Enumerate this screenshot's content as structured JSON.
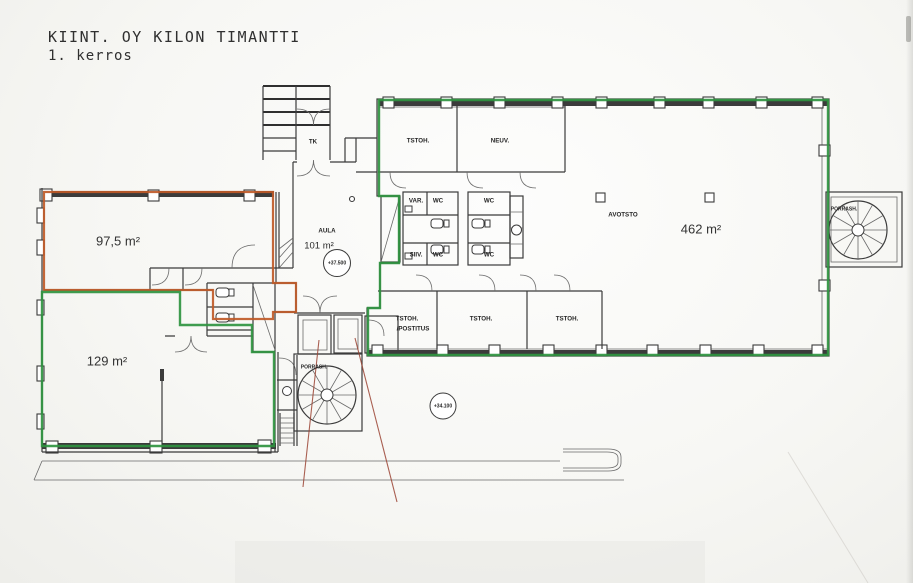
{
  "document": {
    "title": "KIINT. OY KILON TIMANTTI",
    "subtitle": "1. kerros"
  },
  "colors": {
    "unit_a_outline": "#bf5a28",
    "unit_b_outline": "#2f9440",
    "walls": "#3b3b3b",
    "leader_lines": "#9b4434"
  },
  "units": {
    "unit_a": {
      "area": "97,5 m²"
    },
    "unit_b": {
      "area": "129 m²"
    },
    "open_office_unit": {
      "area": "462 m²"
    }
  },
  "rooms": {
    "aula": {
      "name": "AULA",
      "area": "101 m²"
    },
    "tk": {
      "name": "TK"
    },
    "tstoh": {
      "name": "TSTOH."
    },
    "neuv": {
      "name": "NEUV."
    },
    "var": {
      "name": "VAR."
    },
    "wc": {
      "name": "WC"
    },
    "siiv": {
      "name": "SIIV."
    },
    "avotsto": {
      "name": "AVOTSTO"
    },
    "tstoh_postitus": {
      "line1": "TSTOH.",
      "line2": "/POSTITUS"
    },
    "porrash": {
      "name": "PORRASH."
    }
  },
  "level_marks": {
    "entrance": "+37.500",
    "lower": "+34.100"
  }
}
